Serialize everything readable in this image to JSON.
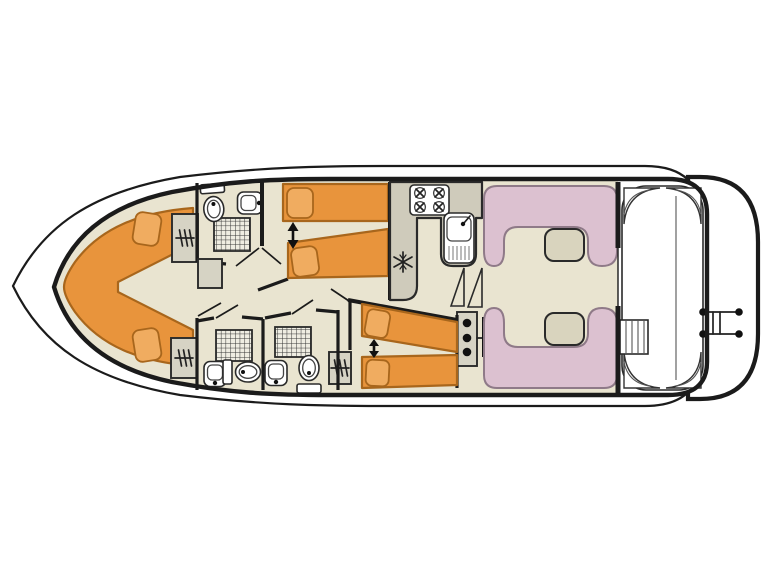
{
  "diagram": {
    "type": "boat-floor-plan",
    "description": "Top-down deck plan of a canal cruiser houseboat, bow pointing left, stern with aft deck and swim platform on the right",
    "orientation": "bow-left-stern-right"
  },
  "colors": {
    "background": "#ffffff",
    "outline": "#1b1b1b",
    "floor": "#e9e4d0",
    "bed": "#e8943c",
    "bed_outline": "#a8661c",
    "pillow": "#f0ac60",
    "seat": "#dcc1d0",
    "seat_outline": "#8f7a88",
    "table": "#d9d4be",
    "furniture": "#d6d3c4",
    "counter": "#cfcbbb",
    "shower_tile": "#efede2",
    "deck_line": "#555555"
  },
  "rooms": [
    {
      "name": "bow-cabin",
      "furniture": [
        "v-shaped-double-berth",
        "pillow",
        "pillow",
        "wardrobe",
        "wardrobe"
      ]
    },
    {
      "name": "fore-bathroom",
      "furniture": [
        "shower",
        "toilet",
        "washbasin",
        "cabinet"
      ]
    },
    {
      "name": "twin-cabin-fore",
      "furniture": [
        "single-berth",
        "single-berth",
        "berth-slide-arrow"
      ]
    },
    {
      "name": "galley",
      "furniture": [
        "four-burner-stove",
        "sink-with-drainer",
        "refrigerator"
      ]
    },
    {
      "name": "bathroom-mid-left",
      "furniture": [
        "shower",
        "toilet",
        "washbasin"
      ]
    },
    {
      "name": "bathroom-mid-right",
      "furniture": [
        "shower",
        "toilet",
        "washbasin"
      ]
    },
    {
      "name": "twin-cabin-aft",
      "furniture": [
        "single-berth",
        "single-berth",
        "berth-slide-arrow",
        "wardrobe"
      ]
    },
    {
      "name": "saloon",
      "furniture": [
        "u-dinette-top",
        "table",
        "u-dinette-bottom",
        "table",
        "companionway-stairs",
        "entry-steps"
      ]
    },
    {
      "name": "aft-deck",
      "furniture": [
        "planked-deck",
        "corner-seat",
        "corner-seat",
        "corner-seat",
        "corner-seat",
        "deck-steps"
      ]
    },
    {
      "name": "swim-platform",
      "furniture": [
        "boarding-ladder"
      ]
    }
  ],
  "symbols": {
    "stove_burners": 4,
    "showers": 3,
    "toilets": 3,
    "washbasins": 3,
    "wardrobes": 3,
    "dinette_tables": 2,
    "berth_slide_arrows": 2,
    "refrigerator_icon": "snowflake",
    "wardrobe_icon": "hanger-hatch",
    "shower_icon": "tiled-grid",
    "ladder_posts": 4
  }
}
